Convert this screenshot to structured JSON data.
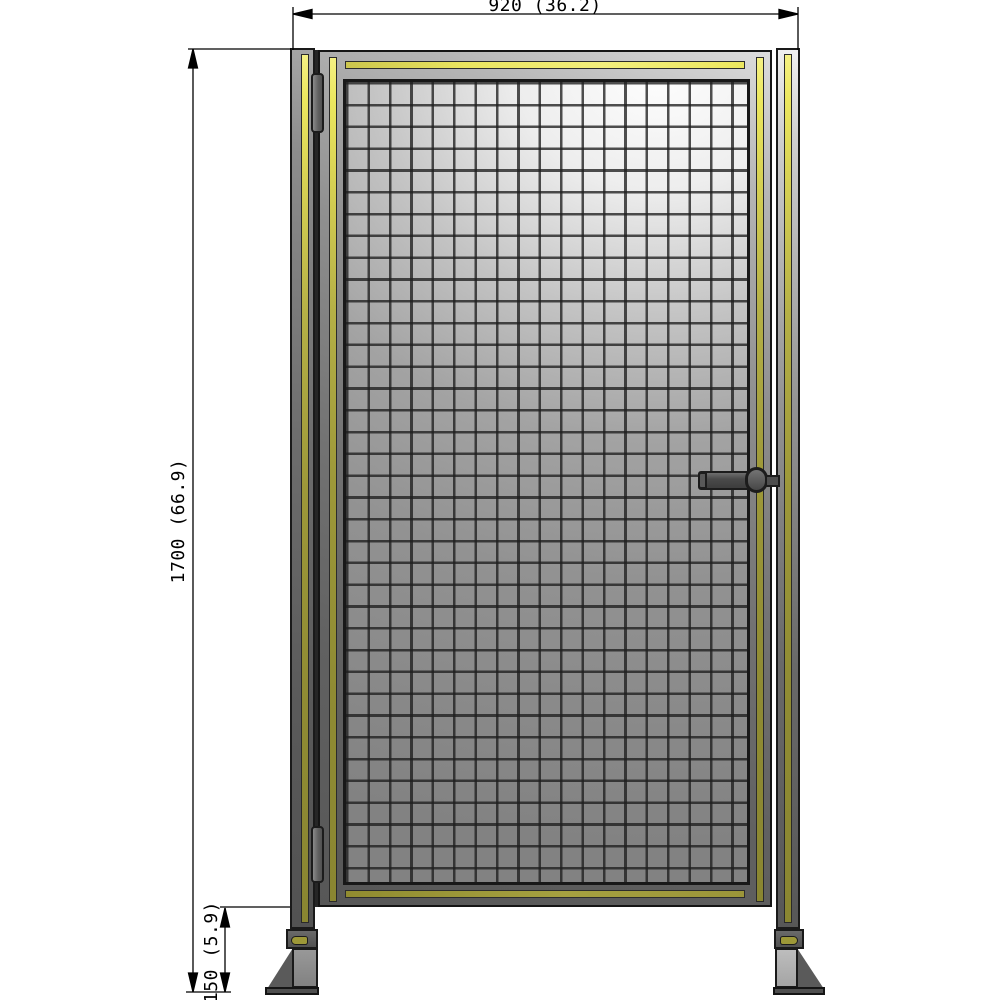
{
  "drawing": {
    "type": "technical-drawing",
    "subject": "wire mesh safety fence gate, front elevation",
    "dimension_labels": {
      "width": "920 (36.2)",
      "height": "1700 (66.9)",
      "ground_clearance": "150 (5.9)"
    },
    "dimension_values": {
      "width_mm": 920,
      "width_in": 36.2,
      "height_mm": 1700,
      "height_in": 66.9,
      "ground_clearance_mm": 150,
      "ground_clearance_in": 5.9
    },
    "colors": {
      "safety_stripe_yellow_bright": "#ece75f",
      "safety_stripe_olive": "#8f8b33",
      "frame_gray": "#737373",
      "outline_black": "#1a1a1a",
      "mesh_fill_light": "#ffffff",
      "mesh_fill_dark": "#828282",
      "background": "#ffffff"
    }
  }
}
